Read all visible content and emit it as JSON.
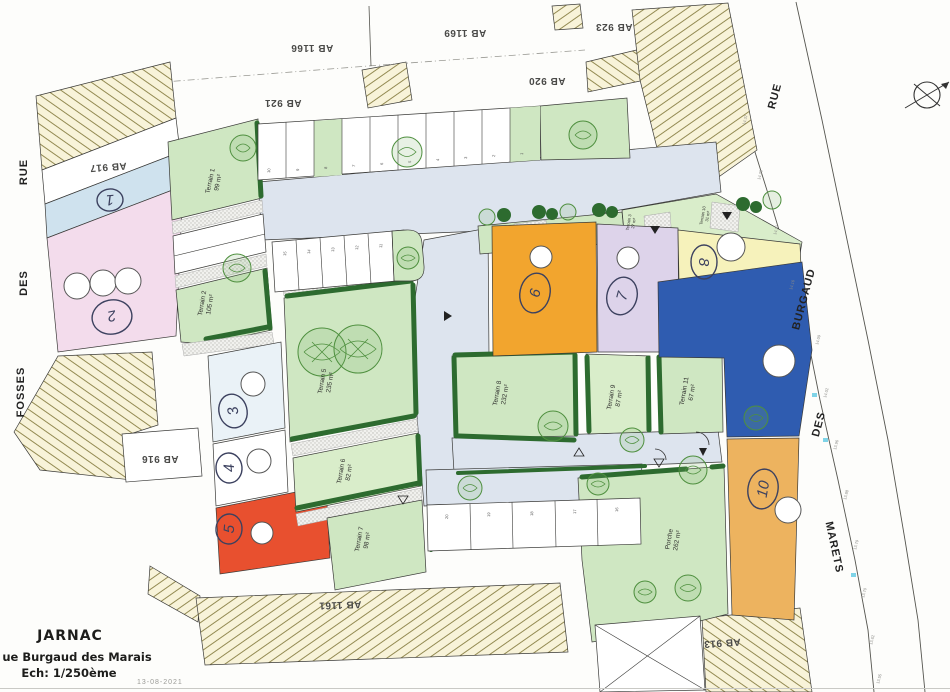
{
  "title_block": {
    "city": "JARNAC",
    "street": "ue Burgaud des Marais",
    "scale": "Ech: 1/250ème",
    "date": "13-08-2021"
  },
  "streets": {
    "left": {
      "word1": "RUE",
      "word2": "DES",
      "word3": "FOSSES"
    },
    "right": {
      "word1": "RUE",
      "word2": "BURGAUD",
      "word3": "DES",
      "word4": "MARETS"
    }
  },
  "cadastral": {
    "ab921": "AB 921",
    "ab1166": "AB 1166",
    "ab1169": "AB 1169",
    "ab920": "AB 920",
    "ab923": "AB 923",
    "ab917": "AB 917",
    "ab916": "AB 916",
    "ab1161": "AB 1161",
    "ab913": "AB 913"
  },
  "terrains": {
    "t1": {
      "name": "Terrain 1",
      "area": "99 m²"
    },
    "t2": {
      "name": "Terrain 2",
      "area": "105 m²"
    },
    "t3": {
      "name": "Terrain 3",
      "area": "27 m²"
    },
    "t5": {
      "name": "Terrain 5",
      "area": "235 m²"
    },
    "t6": {
      "name": "Terrain 6",
      "area": "82 m²"
    },
    "t7": {
      "name": "Terrain 7",
      "area": "98 m²"
    },
    "t8": {
      "name": "Terrain 8",
      "area": "232 m²"
    },
    "t9": {
      "name": "Terrain 9",
      "area": "87 m²"
    },
    "t10": {
      "name": "Terrain 10",
      "area": "31 m²"
    },
    "t11": {
      "name": "Terrain 11",
      "area": "67 m²"
    },
    "porche": {
      "name": "Porche",
      "area": "262 m²"
    }
  },
  "lots": {
    "l1": "1",
    "l2": "2",
    "l3": "3",
    "l4": "4",
    "l5": "5",
    "l6": "6",
    "l7": "7",
    "l8": "8",
    "l10": "10"
  },
  "parking": {
    "top": [
      "10",
      "9",
      "8",
      "7",
      "6",
      "5",
      "4",
      "3",
      "2",
      "1"
    ],
    "middle": [
      "15",
      "14",
      "13",
      "12",
      "11"
    ],
    "bottom": [
      "20",
      "19",
      "18",
      "17",
      "16"
    ]
  },
  "elevations": [
    "14.37",
    "14.28",
    "14.21",
    "14.16",
    "14.09",
    "14.02",
    "13.96",
    "13.88",
    "13.79",
    "13.70",
    "13.62",
    "13.55"
  ],
  "colors": {
    "parcel_green": "#cfe7c2",
    "hedge_green": "#2d6b2f",
    "road_grey": "#dde4ee",
    "lot_orange": "#f2a52e",
    "lot_lavender": "#ddd3ea",
    "lot_yellow": "#f6f2bb",
    "lot_blue": "#2f5cb0",
    "lot_tan": "#edb35f",
    "lot_red": "#e8502f",
    "lot_pink": "#f3dcec",
    "lot_lightblue": "#cfe2ee",
    "hatch_beige": "#f8f3d9"
  }
}
